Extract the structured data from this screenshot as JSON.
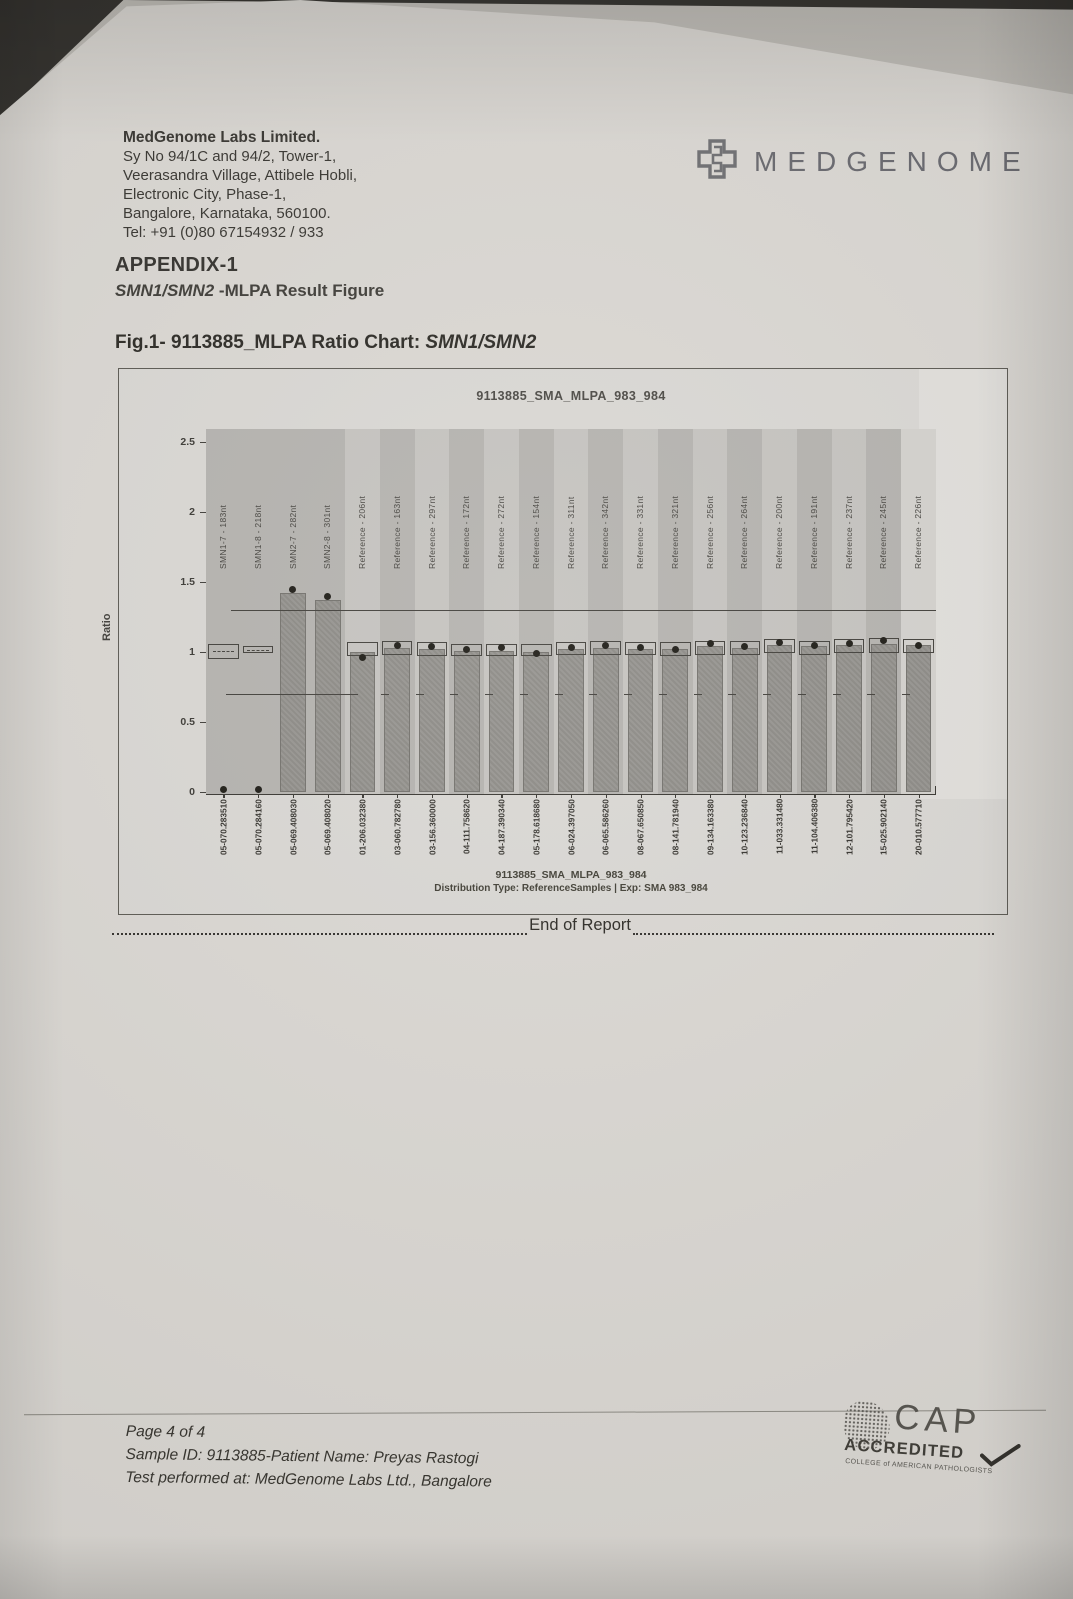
{
  "header": {
    "company_name": "MedGenome Labs Limited.",
    "address_line1": "Sy No 94/1C and 94/2, Tower-1,",
    "address_line2": "Veerasandra Village, Attibele Hobli,",
    "address_line3": "Electronic City, Phase-1,",
    "address_line4": "Bangalore, Karnataka, 560100.",
    "address_line5": "Tel: +91 (0)80 67154932 / 933",
    "logo_text": "MEDGENOME"
  },
  "appendix": {
    "title": "APPENDIX-1",
    "subtitle_gene": "SMN1/SMN2",
    "subtitle_rest": " -MLPA Result Figure"
  },
  "figure_caption": {
    "prefix": "Fig.1- 9113885_MLPA Ratio Chart: ",
    "gene": "SMN1/SMN2"
  },
  "end_of_report": "End of Report",
  "footer": {
    "page_info": "Page 4 of 4",
    "sample_line": "Sample ID: 9113885-Patient Name: Preyas Rastogi",
    "test_line": "Test performed at: MedGenome Labs Ltd., Bangalore"
  },
  "cap_logo": {
    "line1": "CAP",
    "line2": "ACCREDITED",
    "line3": "COLLEGE of AMERICAN PATHOLOGISTS"
  },
  "chart_data": {
    "type": "bar",
    "title": "9113885_SMA_MLPA_983_984",
    "ylabel": "Ratio",
    "ylim": [
      0,
      2.5
    ],
    "yticks": [
      "2.5",
      "2",
      "1.5",
      "1",
      "0.5",
      "0"
    ],
    "grid": false,
    "legend": "none",
    "reference_lines": {
      "upper": 1.3,
      "lower": 0.7
    },
    "caption_line1": "9113885_SMA_MLPA_983_984",
    "caption_line2": "Distribution Type: ReferenceSamples | Exp: SMA 983_984",
    "colors": {
      "paper": "#d9d6d1",
      "ink": "#2f2d29",
      "bar_fill": "#8f8d88",
      "dot": "#17150f"
    },
    "columns": [
      {
        "probe": "SMN1-7 - 183nt",
        "sample": "05-070.283510",
        "bar": 0,
        "dot": 0.02,
        "box": [
          0.95,
          1.06
        ]
      },
      {
        "probe": "SMN1-8 - 218nt",
        "sample": "05-070.284160",
        "bar": 0,
        "dot": 0.02,
        "box": [
          0.99,
          1.04
        ]
      },
      {
        "probe": "SMN2-7 - 282nt",
        "sample": "05-069.408030",
        "bar": 1.42,
        "dot": 1.45,
        "box": null
      },
      {
        "probe": "SMN2-8 - 301nt",
        "sample": "05-069.408020",
        "bar": 1.37,
        "dot": 1.4,
        "box": null
      },
      {
        "probe": "Reference - 206nt",
        "sample": "01-206.032380",
        "bar": 1.0,
        "dot": 0.96,
        "box": [
          0.97,
          1.07
        ]
      },
      {
        "probe": "Reference - 163nt",
        "sample": "03-060.782780",
        "bar": 1.03,
        "dot": 1.05,
        "box": [
          0.98,
          1.08
        ]
      },
      {
        "probe": "Reference - 297nt",
        "sample": "03-156.360000",
        "bar": 1.02,
        "dot": 1.04,
        "box": [
          0.97,
          1.07
        ]
      },
      {
        "probe": "Reference - 172nt",
        "sample": "04-111.758620",
        "bar": 1.01,
        "dot": 1.02,
        "box": [
          0.97,
          1.06
        ]
      },
      {
        "probe": "Reference - 272nt",
        "sample": "04-187.390340",
        "bar": 1.01,
        "dot": 1.03,
        "box": [
          0.97,
          1.06
        ]
      },
      {
        "probe": "Reference - 154nt",
        "sample": "05-178.618680",
        "bar": 1.0,
        "dot": 0.99,
        "box": [
          0.97,
          1.06
        ]
      },
      {
        "probe": "Reference - 311nt",
        "sample": "06-024.397050",
        "bar": 1.02,
        "dot": 1.03,
        "box": [
          0.98,
          1.07
        ]
      },
      {
        "probe": "Reference - 342nt",
        "sample": "06-065.586260",
        "bar": 1.03,
        "dot": 1.05,
        "box": [
          0.98,
          1.08
        ]
      },
      {
        "probe": "Reference - 331nt",
        "sample": "08-067.650850",
        "bar": 1.02,
        "dot": 1.03,
        "box": [
          0.98,
          1.07
        ]
      },
      {
        "probe": "Reference - 321nt",
        "sample": "08-141.781940",
        "bar": 1.02,
        "dot": 1.02,
        "box": [
          0.97,
          1.07
        ]
      },
      {
        "probe": "Reference - 256nt",
        "sample": "09-134.163380",
        "bar": 1.04,
        "dot": 1.06,
        "box": [
          0.98,
          1.08
        ]
      },
      {
        "probe": "Reference - 264nt",
        "sample": "10-123.236840",
        "bar": 1.03,
        "dot": 1.04,
        "box": [
          0.98,
          1.08
        ]
      },
      {
        "probe": "Reference - 200nt",
        "sample": "11-033.331480",
        "bar": 1.05,
        "dot": 1.07,
        "box": [
          0.99,
          1.09
        ]
      },
      {
        "probe": "Reference - 191nt",
        "sample": "11-104.406380",
        "bar": 1.04,
        "dot": 1.05,
        "box": [
          0.98,
          1.08
        ]
      },
      {
        "probe": "Reference - 237nt",
        "sample": "12-101.795420",
        "bar": 1.05,
        "dot": 1.06,
        "box": [
          0.99,
          1.09
        ]
      },
      {
        "probe": "Reference - 245nt",
        "sample": "15-025.902140",
        "bar": 1.06,
        "dot": 1.08,
        "box": [
          0.99,
          1.1
        ]
      },
      {
        "probe": "Reference - 226nt",
        "sample": "20-010.577710",
        "bar": 1.05,
        "dot": 1.05,
        "box": [
          0.99,
          1.09
        ]
      }
    ]
  }
}
